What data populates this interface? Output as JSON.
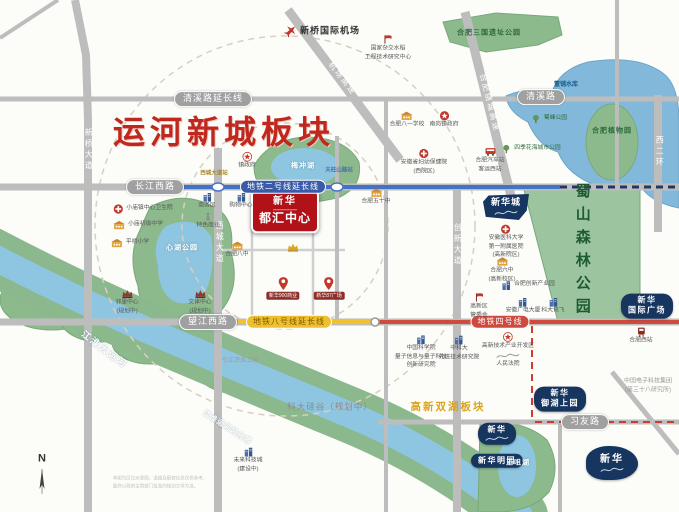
{
  "map": {
    "colors": {
      "title_red": "#c0281d",
      "project_red": "#b01217",
      "navy_badge": "#16355f",
      "metro_line2_blue": "#4472c4",
      "metro_line8_yellow": "#f2c12e",
      "metro_line4_red": "#d04a3e",
      "boundary_red_dash": "#d23b2f",
      "park_green": "#8cba8c",
      "water_blue": "#8ec6e2",
      "road_gray": "#bdbdbd"
    },
    "items": [
      {
        "n": "title-canal-new-city-block",
        "t": "title",
        "x": 224,
        "y": 133,
        "l": [
          "运河新城板块"
        ]
      },
      {
        "n": "project-badge-xinhua-duhui-center",
        "t": "project",
        "x": 285,
        "y": 211,
        "l": [
          "新华",
          "都汇中心"
        ]
      },
      {
        "n": "road-label-qingxi-extension",
        "t": "road",
        "x": 213,
        "y": 99,
        "l": [
          "清溪路延长线"
        ]
      },
      {
        "n": "road-label-qingxi",
        "t": "road",
        "x": 541,
        "y": 97,
        "l": [
          "清溪路"
        ]
      },
      {
        "n": "road-label-changjiang-west",
        "t": "road",
        "x": 155,
        "y": 187,
        "l": [
          "长江西路"
        ]
      },
      {
        "n": "road-label-wangjiang-west",
        "t": "road",
        "x": 208,
        "y": 322,
        "l": [
          "望江西路"
        ]
      },
      {
        "n": "road-label-xiyou",
        "t": "road",
        "x": 585,
        "y": 422,
        "l": [
          "习友路"
        ]
      },
      {
        "n": "metro-line2-extension-label",
        "t": "mblue",
        "x": 283,
        "y": 187,
        "l": [
          "地铁二号线延长线"
        ]
      },
      {
        "n": "metro-line8-extension-label",
        "t": "myellow",
        "x": 289,
        "y": 322,
        "l": [
          "地铁八号线延长线"
        ]
      },
      {
        "n": "metro-line4-label",
        "t": "mred",
        "x": 500,
        "y": 322,
        "l": [
          "地铁四号线"
        ]
      },
      {
        "n": "road-label-xinqiao-avenue",
        "t": "vroad",
        "x": 88,
        "y": 150,
        "l": [
          "新桥大道"
        ]
      },
      {
        "n": "road-label-xicheng-avenue",
        "t": "vroad",
        "x": 219,
        "y": 243,
        "l": [
          "西城大道"
        ]
      },
      {
        "n": "road-label-chuangxin-avenue",
        "t": "vroad",
        "x": 457,
        "y": 245,
        "l": [
          "创新大道"
        ]
      },
      {
        "n": "road-label-west-2nd-ring",
        "t": "vroad",
        "x": 659,
        "y": 152,
        "l": [
          "西二环"
        ]
      },
      {
        "n": "road-label-airport-expressway",
        "t": "droad",
        "x": 342,
        "y": 79,
        "rot": 52,
        "l": [
          "机场高速"
        ]
      },
      {
        "n": "road-label-ring-expressway",
        "t": "droad",
        "x": 489,
        "y": 103,
        "rot": 76,
        "l": [
          "合肥绕城高速"
        ]
      },
      {
        "n": "station-xicheng-avenue",
        "t": "station",
        "x": 214,
        "y": 174,
        "c": "#a8862a",
        "l": [
          "西城大道站"
        ]
      },
      {
        "n": "station-tianzhushan-road",
        "t": "station",
        "x": 339,
        "y": 171,
        "c": "#4a6fa5",
        "l": [
          "天柱山路站"
        ]
      },
      {
        "n": "poi-xinqiao-intl-airport",
        "t": "poi",
        "row": 1,
        "cls": "big",
        "x": 322,
        "y": 31,
        "icon": "plane",
        "l": [
          "新桥国际机场"
        ]
      },
      {
        "n": "poi-hybrid-rice-research-center",
        "t": "poi",
        "x": 388,
        "y": 48,
        "icon": "flag",
        "l": [
          "国家杂交水稻",
          "工程技术研究中心"
        ]
      },
      {
        "n": "poi-hefei-bayi-school",
        "t": "poi",
        "x": 407,
        "y": 120,
        "icon": "school",
        "l": [
          "合肥八一学校"
        ]
      },
      {
        "n": "poi-nangang-town-gov",
        "t": "poi",
        "x": 444,
        "y": 120,
        "icon": "gov",
        "l": [
          "南岗镇政府"
        ]
      },
      {
        "n": "poi-shufeng-park",
        "t": "poi",
        "row": 1,
        "cls": "greenlbl",
        "x": 549,
        "y": 119,
        "icon": "tree",
        "l": [
          "蜀峰公园"
        ]
      },
      {
        "n": "poi-four-seasons-flower-park",
        "t": "poi",
        "row": 1,
        "cls": "greenlbl",
        "x": 531,
        "y": 149,
        "icon": "tree",
        "l": [
          "四季花海城市公园"
        ]
      },
      {
        "n": "poi-hefei-west-bus-station",
        "t": "poi",
        "x": 490,
        "y": 160,
        "icon": "bus",
        "l": [
          "合肥汽车站",
          "客运西站"
        ]
      },
      {
        "n": "poi-anhui-women-children-hospital",
        "t": "poi",
        "x": 424,
        "y": 162,
        "icon": "hospital",
        "l": [
          "安徽省妇幼保健院",
          "(西院区)"
        ]
      },
      {
        "n": "poi-town-government",
        "t": "poi",
        "x": 247,
        "y": 161,
        "icon": "starred",
        "l": [
          "镇政府"
        ]
      },
      {
        "n": "poi-business-district",
        "t": "poi",
        "x": 207,
        "y": 201,
        "icon": "building",
        "l": [
          "商务区"
        ]
      },
      {
        "n": "poi-shopping-center",
        "t": "poi",
        "x": 241,
        "y": 201,
        "icon": "building",
        "l": [
          "购物中心"
        ]
      },
      {
        "n": "poi-feature-commerce",
        "t": "poi",
        "x": 208,
        "y": 221,
        "icon": "statue",
        "l": [
          "特色商业"
        ]
      },
      {
        "n": "poi-hefei-no8-middle-school",
        "t": "poi",
        "x": 237,
        "y": 250,
        "icon": "school",
        "l": [
          "合肥八中"
        ]
      },
      {
        "n": "landmark-crown",
        "t": "poi",
        "x": 293,
        "y": 247,
        "icon": "crown",
        "l": []
      },
      {
        "n": "poi-hefei-no50-middle-school",
        "t": "poi",
        "x": 376,
        "y": 197,
        "icon": "school",
        "l": [
          "合肥五十中"
        ]
      },
      {
        "n": "poi-xiaomiao-health-center",
        "t": "poi",
        "row": 1,
        "x": 143,
        "y": 209,
        "icon": "hospital",
        "l": [
          "小庙镇中心卫生院"
        ]
      },
      {
        "n": "poi-xiaomiao-junior-school",
        "t": "poi",
        "row": 1,
        "x": 138,
        "y": 225,
        "icon": "school",
        "l": [
          "小庙初级中学"
        ]
      },
      {
        "n": "poi-pingqiao-primary-school",
        "t": "poi",
        "row": 1,
        "x": 130,
        "y": 243,
        "icon": "school",
        "l": [
          "平桥小学"
        ]
      },
      {
        "n": "poi-anhui-medical-univ-hospital",
        "t": "poi",
        "x": 506,
        "y": 242,
        "icon": "hospital",
        "l": [
          "安徽医科大学",
          "第一附属医院",
          "(高新院区)"
        ]
      },
      {
        "n": "poi-hefei-no6-middle-school",
        "t": "poi",
        "x": 502,
        "y": 270,
        "icon": "school",
        "l": [
          "合肥六中",
          "(高新校区)"
        ]
      },
      {
        "n": "poi-innovation-industrial-park",
        "t": "poi",
        "row": 1,
        "x": 528,
        "y": 285,
        "icon": "building",
        "l": [
          "合肥创新产业园"
        ]
      },
      {
        "n": "poi-hitech-admin-committee",
        "t": "poi",
        "x": 479,
        "y": 306,
        "icon": "flag",
        "l": [
          "高新区",
          "管委会"
        ]
      },
      {
        "n": "poi-anhui-broadcast-tower",
        "t": "poi",
        "x": 523,
        "y": 306,
        "icon": "building",
        "l": [
          "安徽广电大厦"
        ]
      },
      {
        "n": "poi-iflytek",
        "t": "poi",
        "x": 553,
        "y": 306,
        "icon": "building",
        "l": [
          "科大讯飞"
        ]
      },
      {
        "n": "poi-hitech-district-court",
        "t": "poi",
        "x": 508,
        "y": 350,
        "icon": "starred",
        "fl": 1,
        "l": [
          "高新技术产业开发区",
          "人民法院"
        ]
      },
      {
        "n": "poi-cas-quantum-institute",
        "t": "poi",
        "x": 421,
        "y": 352,
        "icon": "building",
        "l": [
          "中国科学院",
          "量子信息与量子科技",
          "创新研究院"
        ]
      },
      {
        "n": "poi-ustc-advanced-institute",
        "t": "poi",
        "x": 459,
        "y": 348,
        "icon": "building",
        "l": [
          "中科大",
          "先进技术研究院"
        ]
      },
      {
        "n": "poi-hefei-west-railway-station",
        "t": "poi",
        "x": 641,
        "y": 336,
        "icon": "train",
        "l": [
          "合肥西站"
        ]
      },
      {
        "n": "poi-cetc-38th-institute",
        "t": "text",
        "x": 648,
        "y": 387,
        "l": [
          "中国电子科技集团",
          "(第三十八研究所)"
        ]
      },
      {
        "n": "poi-future-tech-city",
        "t": "poi",
        "x": 248,
        "y": 460,
        "icon": "building",
        "l": [
          "未来科技城",
          "(建设中)"
        ]
      },
      {
        "n": "poi-neighborhood-center",
        "t": "poi",
        "x": 127,
        "y": 302,
        "icon": "crownm",
        "l": [
          "邻里中心",
          "(规划中)"
        ]
      },
      {
        "n": "poi-culture-sports-center",
        "t": "poi",
        "x": 200,
        "y": 302,
        "icon": "crownm",
        "l": [
          "文体中心",
          "(规划中)"
        ]
      },
      {
        "n": "pin-xinhua-900-commerce",
        "t": "pinlbl",
        "x": 283,
        "y": 288,
        "icon": "pin",
        "l": [
          "新华900商业"
        ]
      },
      {
        "n": "pin-xinhua-87-plaza",
        "t": "pinlbl",
        "x": 329,
        "y": 288,
        "icon": "pin",
        "l": [
          "新华87广场"
        ]
      },
      {
        "n": "badge-xinhua-city",
        "t": "navyflag",
        "x": 506,
        "y": 207,
        "fl": 1,
        "l": [
          "新华城"
        ]
      },
      {
        "n": "badge-xinhua-intl-plaza",
        "t": "navy",
        "x": 647,
        "y": 306,
        "l": [
          "新华",
          "国际广场"
        ]
      },
      {
        "n": "badge-xinhua-yuhu-upper-garden",
        "t": "navy",
        "x": 560,
        "y": 399,
        "l": [
          "新华",
          "御湖上园"
        ]
      },
      {
        "n": "badge-xinhua-script",
        "t": "navy",
        "x": 497,
        "y": 434,
        "fl": 1,
        "l": [
          "新华"
        ]
      },
      {
        "n": "badge-xinhua-mingyuan",
        "t": "navy",
        "x": 497,
        "y": 461,
        "l": [
          "新华明园"
        ]
      },
      {
        "n": "badge-xinhua-southeast",
        "t": "navyblob",
        "x": 612,
        "y": 463,
        "fl": 1,
        "l": [
          "新华"
        ]
      },
      {
        "n": "area-keda-silicon-valley",
        "t": "text",
        "cls": "big2",
        "x": 330,
        "y": 407,
        "l": [
          "科大硅谷（规划中）"
        ]
      },
      {
        "n": "area-hitech-twin-lakes-block",
        "t": "gold",
        "x": 448,
        "y": 408,
        "l": [
          "高新双湖板块"
        ]
      },
      {
        "n": "water-jianghuai-grand-canal",
        "t": "water",
        "cls": "big",
        "x": 104,
        "y": 350,
        "rot": 37,
        "l": [
          "江淮大运河"
        ]
      },
      {
        "n": "water-canal-scenic-belt",
        "t": "water",
        "x": 227,
        "y": 428,
        "rot": 33,
        "l": [
          "江淮运河风光带"
        ]
      },
      {
        "n": "water-dongpu-reservoir",
        "t": "text",
        "cls": "blue",
        "x": 566,
        "y": 86,
        "l": [
          "董铺水库"
        ]
      },
      {
        "n": "water-wangju-lake",
        "t": "water",
        "x": 518,
        "y": 463,
        "l": [
          "王咀湖"
        ]
      },
      {
        "n": "park-xinhu-label",
        "t": "water",
        "x": 182,
        "y": 248,
        "l": [
          "心湖公园"
        ]
      },
      {
        "n": "lake-meichong-label",
        "t": "water",
        "x": 303,
        "y": 166,
        "l": [
          "梅冲湖"
        ]
      },
      {
        "n": "park-sanguo-ruins-label",
        "t": "green",
        "x": 489,
        "y": 33,
        "l": [
          "合肥三国遗址公园"
        ]
      },
      {
        "n": "park-botanical-garden-label",
        "t": "green",
        "x": 612,
        "y": 131,
        "l": [
          "合肥植物园"
        ]
      },
      {
        "n": "forest-shushan-label",
        "t": "forest",
        "x": 582,
        "y": 252,
        "l": [
          "蜀山森林公园"
        ]
      },
      {
        "n": "project-yinjiang-jihuai",
        "t": "text",
        "x": 240,
        "y": 362,
        "l": [
          "引江济淮工程"
        ]
      },
      {
        "n": "compass-north",
        "t": "compass",
        "x": 42,
        "y": 474,
        "l": [
          "N"
        ]
      },
      {
        "n": "map-disclaimer",
        "t": "disc",
        "x": 160,
        "y": 482,
        "l": [
          "本图为区位示意图，道路及配套信息仅供参考，",
          "最终以政府主管部门批准的规划文件为准。"
        ]
      }
    ]
  }
}
